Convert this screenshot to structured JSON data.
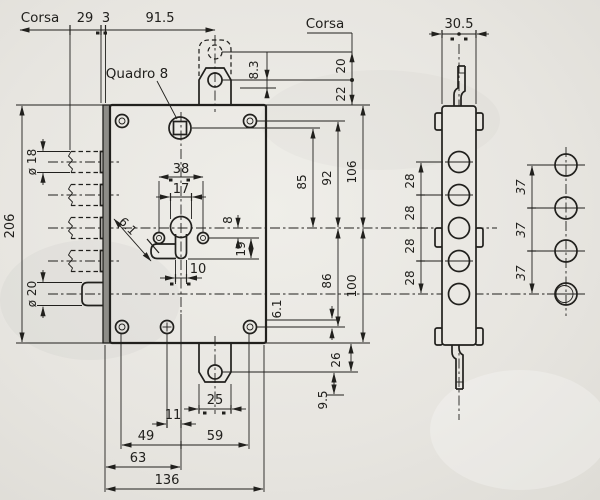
{
  "title": "Lock mechanism technical drawing",
  "colors": {
    "paper": "#eae8e3",
    "ink": "#21201d",
    "plate": "#8e8d88"
  },
  "labels": {
    "corsa_left": "Corsa",
    "corsa_right": "Corsa",
    "quadro": "Quadro 8",
    "top": {
      "c29": "29",
      "c3": "3",
      "c915": "91.5"
    },
    "latch": {
      "d83": "8.3",
      "d20": "20",
      "d22": "22"
    },
    "left": {
      "d206": "206",
      "dia18": "ø 18",
      "dia20": "ø 20"
    },
    "cyl": {
      "d38": "38",
      "d17": "17",
      "d8": "8",
      "d19": "19",
      "d10": "10",
      "d61": "6.1"
    },
    "right": {
      "d85": "85",
      "d92": "92",
      "d106": "106",
      "d86": "86",
      "d100": "100",
      "d61": "6.1",
      "d26": "26",
      "d95": "9.5"
    },
    "bottom": {
      "d25": "25",
      "d11": "11",
      "d49": "49",
      "d59": "59",
      "d63": "63",
      "d136": "136"
    },
    "side": {
      "d305": "30.5",
      "s28": [
        "28",
        "28",
        "28",
        "28"
      ]
    },
    "strike": {
      "s37": [
        "37",
        "37",
        "37"
      ]
    }
  }
}
